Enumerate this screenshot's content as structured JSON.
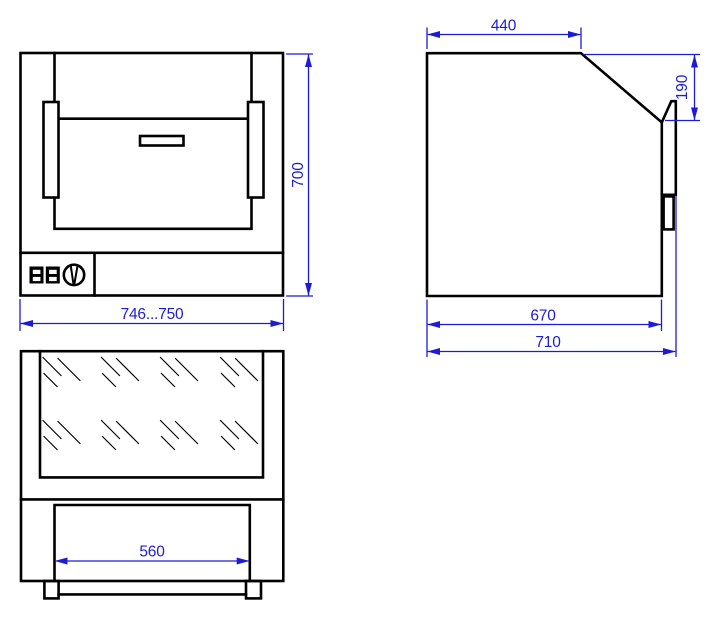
{
  "colors": {
    "line": "#000000",
    "dimension": "#1c1cd6",
    "background": "#ffffff"
  },
  "views": {
    "front": {
      "dimensions": {
        "width": "746...750",
        "height": "700"
      }
    },
    "side": {
      "dimensions": {
        "top_depth": "440",
        "door_height": "190",
        "body_depth": "670",
        "overall_depth": "710"
      }
    },
    "top": {
      "dimensions": {
        "opening_width": "560"
      }
    }
  }
}
